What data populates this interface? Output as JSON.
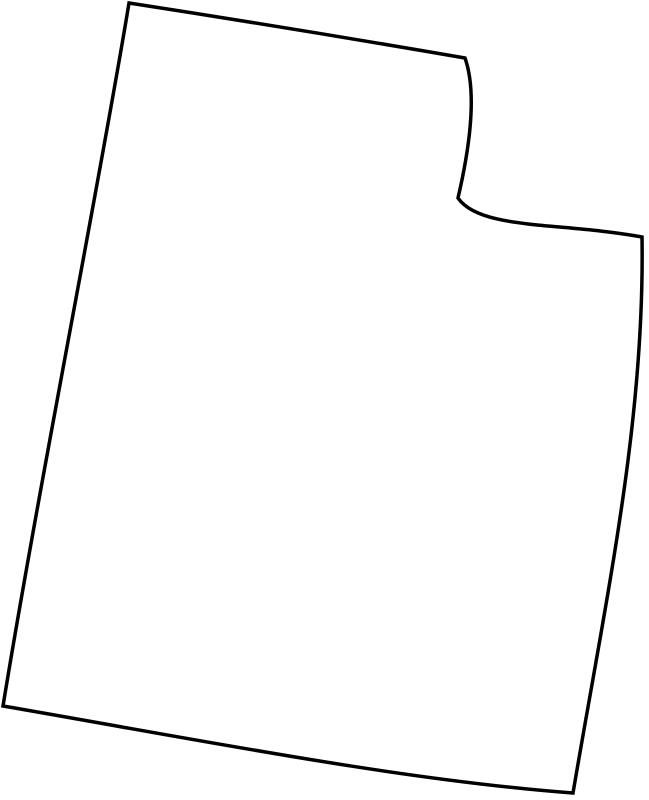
{
  "map": {
    "region_name": "utah-state-outline",
    "outline_path": "M 129 3 Q 297 29 465 58 C 478 95 468 155 458 198 C 480 230 560 222 642 237 C 645 420 607 593 573 793 C 400 780 200 740 3 706 C 40 480 100 180 129 3 Z",
    "stroke_color": "#000000",
    "fill_color": "#ffffff",
    "background_color": "#ffffff",
    "stroke_width": "3.5",
    "viewbox": "0 0 649 800"
  }
}
